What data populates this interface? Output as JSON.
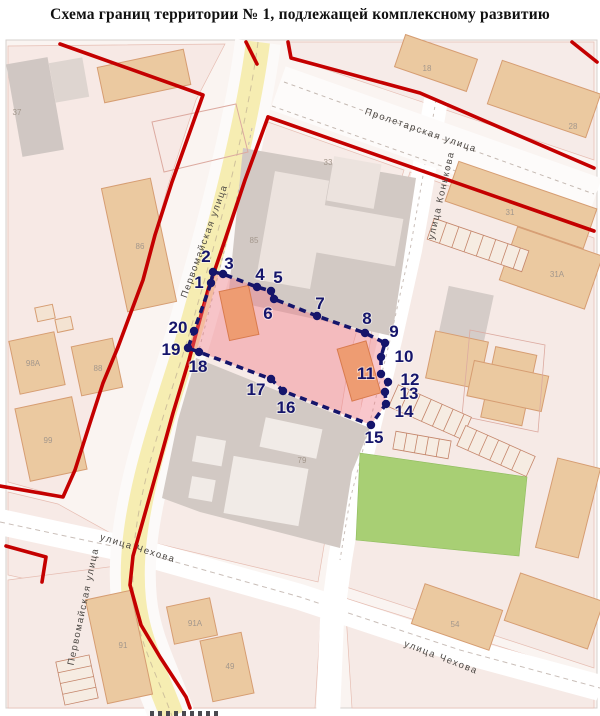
{
  "title": "Схема границ территории № 1, подлежащей комплексному развитию",
  "street_labels": {
    "proletarskaya": "Пролетарская улица",
    "konkova": "улица Конькова",
    "pervomayskaya": "Первомайская улица",
    "chekhova": "улица Чехова"
  },
  "boundary_points": [
    "1",
    "2",
    "3",
    "4",
    "5",
    "6",
    "7",
    "8",
    "9",
    "10",
    "11",
    "12",
    "13",
    "14",
    "15",
    "16",
    "17",
    "18",
    "19",
    "20"
  ],
  "building_labels": {
    "b37": "37",
    "b86": "86",
    "b88": "88",
    "b98a": "98А",
    "b99": "99",
    "b91": "91",
    "b91a": "91А",
    "b49": "49",
    "b85": "85",
    "b87": "87",
    "b33": "33",
    "b79": "79",
    "b18": "18",
    "b28": "28",
    "b31": "31",
    "b31a": "31А",
    "b54": "54"
  },
  "colors": {
    "boundary_line_navy": "#15156b",
    "territory_fill_pink": "#f07a86",
    "red_line": "#c40000",
    "street_yellow": "#f6edb2",
    "park_green": "#a8cf74",
    "building_tan": "#ebc9a0",
    "block_gray": "#d2c9c4"
  }
}
